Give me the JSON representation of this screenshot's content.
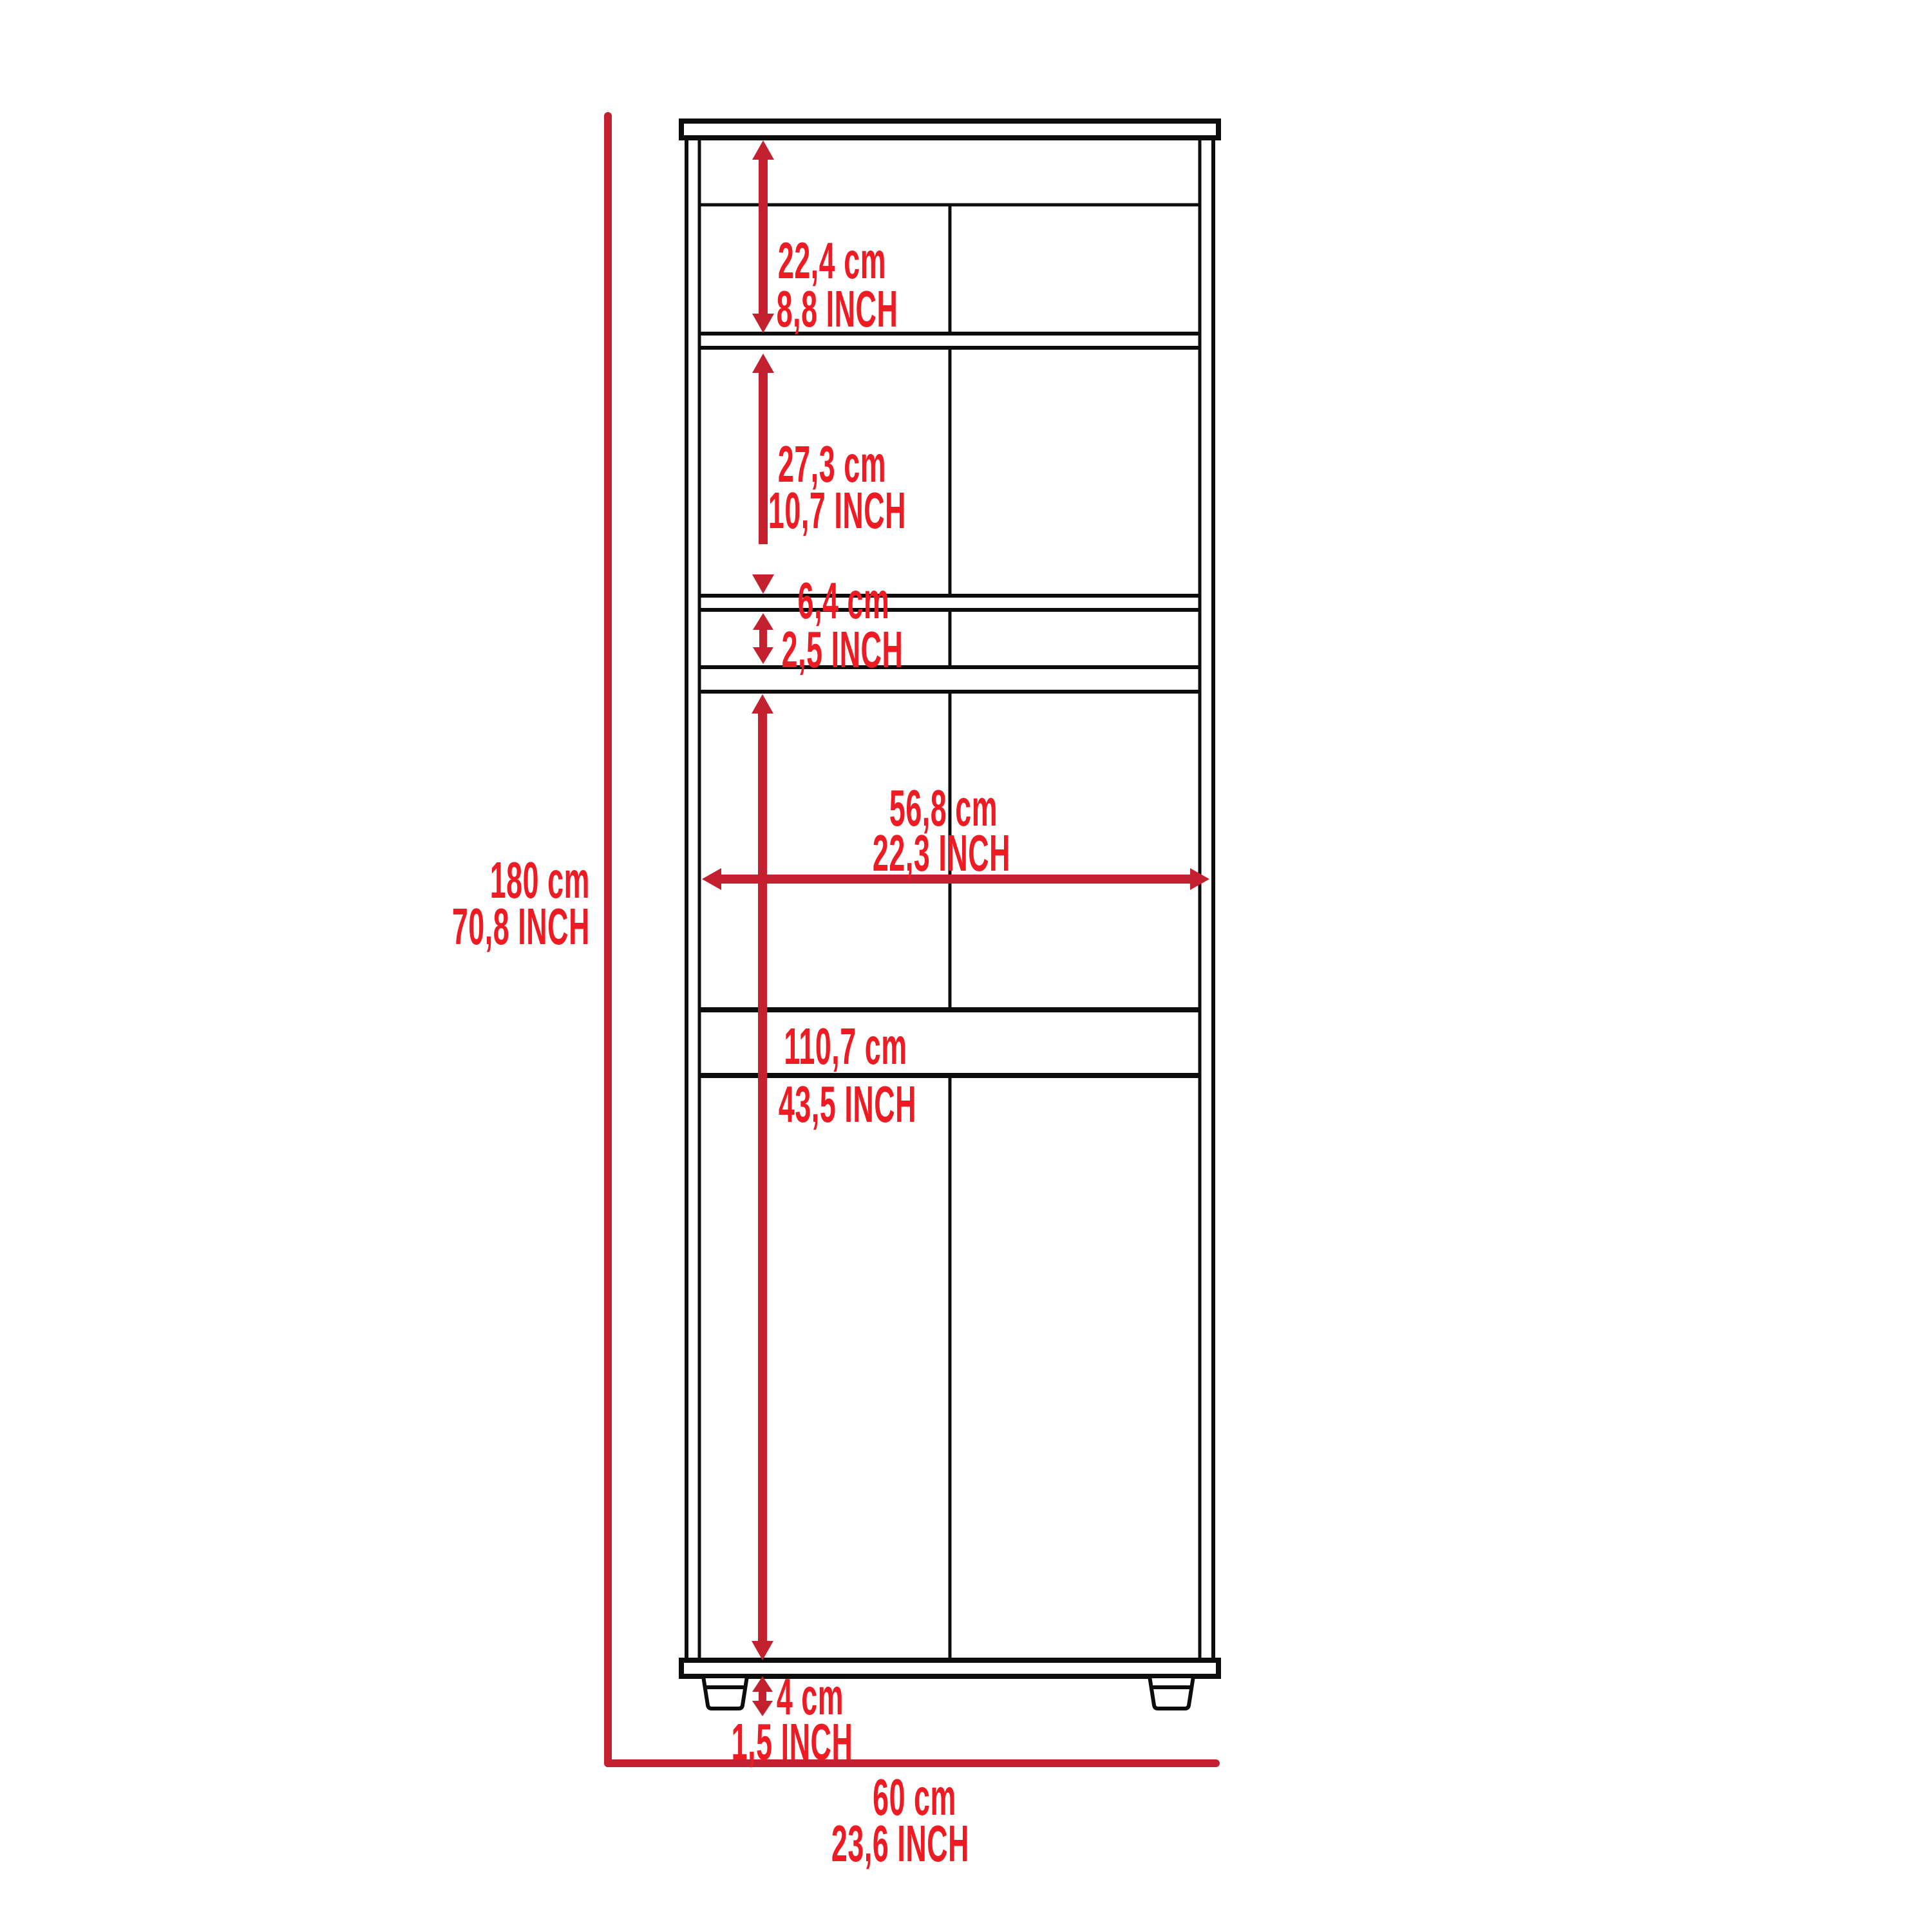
{
  "diagram": {
    "title": "Tall storage cabinet dimension drawing",
    "colors": {
      "background": "#ffffff",
      "outline_black": "#0d0d0d",
      "dimension_arrow_red": "#c3212f",
      "dimension_text_red": "#ed1c24"
    },
    "dimensions": {
      "overall_height": {
        "cm": "180 cm",
        "inch": "70,8 INCH"
      },
      "overall_width": {
        "cm": "60 cm",
        "inch": "23,6 INCH"
      },
      "top_section": {
        "cm": "22,4 cm",
        "inch": "8,8 INCH"
      },
      "upper_door": {
        "cm": "27,3 cm",
        "inch": "10,7 INCH"
      },
      "small_shelf": {
        "cm": "6,4 cm",
        "inch": "2,5 INCH"
      },
      "interior_width": {
        "cm": "56,8 cm",
        "inch": "22,3 INCH"
      },
      "lower_section": {
        "cm": "110,7 cm",
        "inch": "43,5 INCH"
      },
      "foot_height": {
        "cm": "4 cm",
        "inch": "1,5 INCH"
      }
    }
  }
}
